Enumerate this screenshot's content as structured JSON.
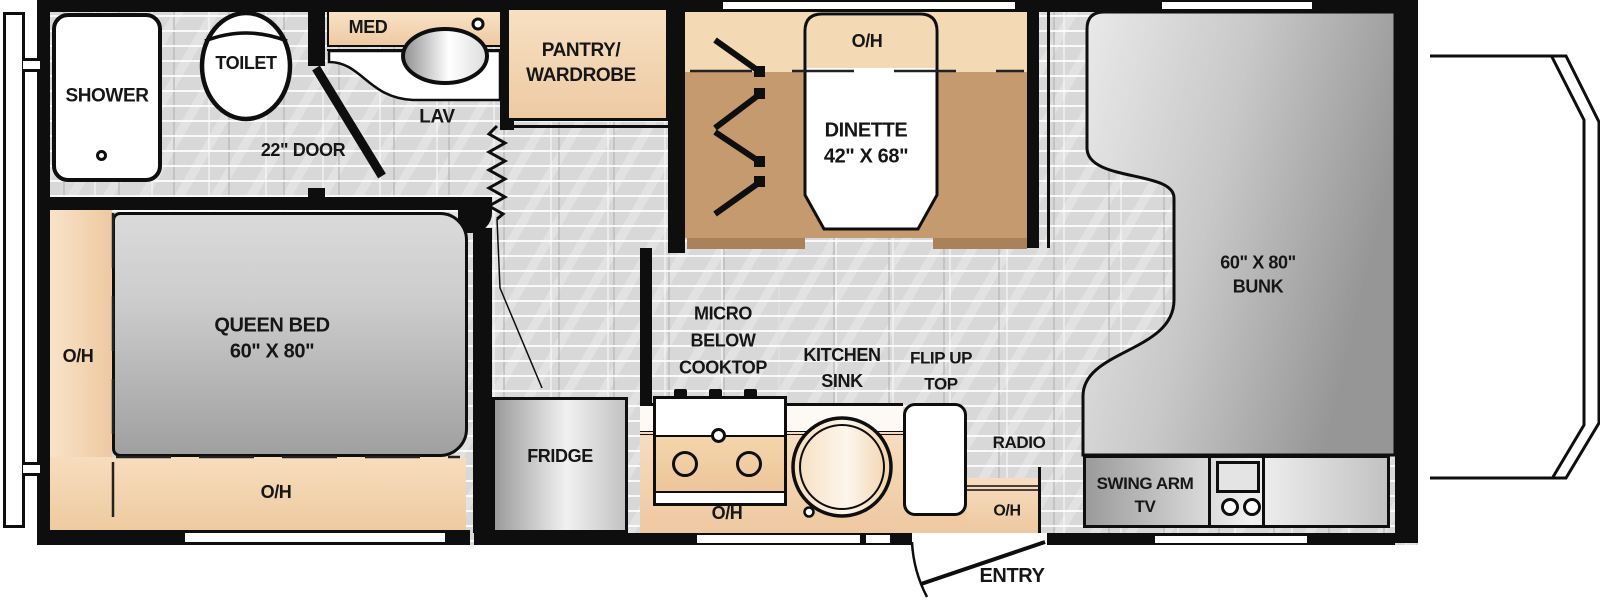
{
  "floorplan": {
    "bathroom": {
      "shower": "SHOWER",
      "toilet": "TOILET",
      "med": "MED",
      "lav": "LAV",
      "door": "22\" DOOR"
    },
    "storage": {
      "pantry_line1": "PANTRY/",
      "pantry_line2": "WARDROBE"
    },
    "dinette": {
      "oh": "O/H",
      "name": "DINETTE",
      "size": "42\" X 68\""
    },
    "bunk": {
      "size": "60\" X 80\"",
      "name": "BUNK"
    },
    "bedroom": {
      "oh_left": "O/H",
      "name": "QUEEN BED",
      "size": "60\" X 80\"",
      "oh_bottom": "O/H"
    },
    "kitchen": {
      "fridge": "FRIDGE",
      "micro_line1": "MICRO",
      "micro_line2": "BELOW",
      "micro_line3": "COOKTOP",
      "sink_line1": "KITCHEN",
      "sink_line2": "SINK",
      "flip_line1": "FLIP UP",
      "flip_line2": "TOP",
      "oh": "O/H"
    },
    "entertainment": {
      "radio": "RADIO",
      "radio_oh": "O/H",
      "tv_line1": "SWING ARM",
      "tv_line2": "TV"
    },
    "entry": {
      "label": "ENTRY"
    }
  },
  "colors": {
    "wall": "#0e0e0e",
    "floor_tile": "#d8d8d8",
    "cabinet_tan": "#f4d9b5",
    "floor_tan": "#c49a6e",
    "bench_front": "#aa8158",
    "furniture_silver": "#c9c9c9"
  }
}
